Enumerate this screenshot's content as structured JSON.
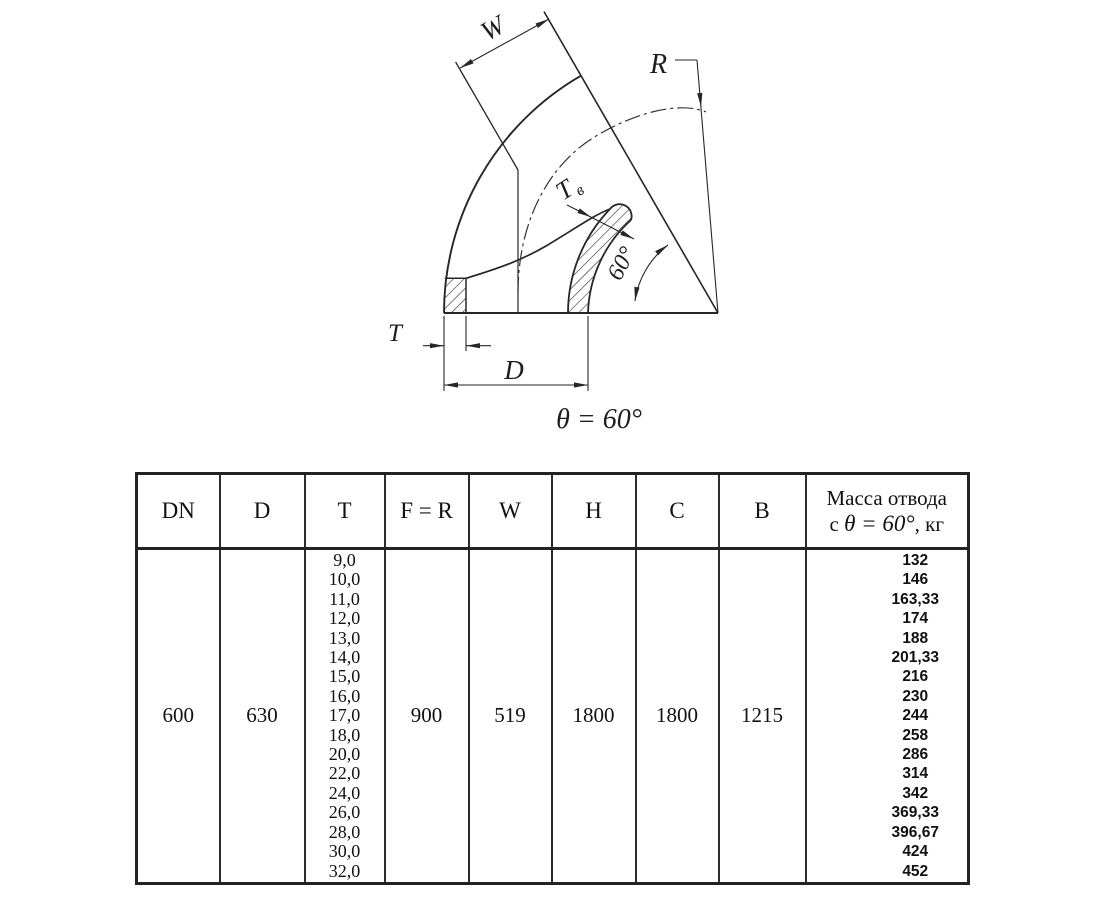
{
  "drawing": {
    "labels": {
      "w": "W",
      "r": "R",
      "t_inner_main": "T",
      "t_inner_sub": "в",
      "angle": "60°",
      "t": "T",
      "d": "D",
      "theta_note": "θ = 60°"
    }
  },
  "table": {
    "col_headers": [
      "DN",
      "D",
      "T",
      "F = R",
      "W",
      "H",
      "C",
      "B"
    ],
    "mass_header": {
      "line1": "Масса отвода",
      "prefix": "с ",
      "angle": "θ = 60°",
      "suffix": ", кг"
    },
    "values": {
      "dn": "600",
      "d": "630",
      "f_r": "900",
      "w": "519",
      "h": "1800",
      "c": "1800",
      "b": "1215"
    },
    "t_values": [
      "9,0",
      "10,0",
      "11,0",
      "12,0",
      "13,0",
      "14,0",
      "15,0",
      "16,0",
      "17,0",
      "18,0",
      "20,0",
      "22,0",
      "24,0",
      "26,0",
      "28,0",
      "30,0",
      "32,0"
    ],
    "mass_values": [
      "132",
      "146",
      "163,33",
      "174",
      "188",
      "201,33",
      "216",
      "230",
      "244",
      "258",
      "286",
      "314",
      "342",
      "369,33",
      "396,67",
      "424",
      "452"
    ]
  }
}
